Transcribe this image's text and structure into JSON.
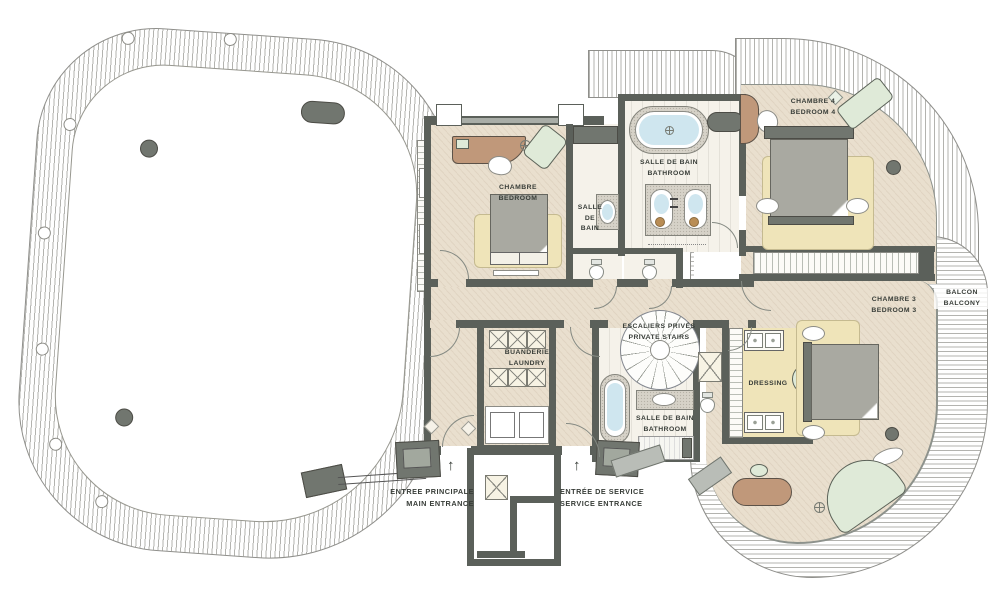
{
  "colors": {
    "wall": "#5b605a",
    "ink": "#383d38",
    "floor": "#e9dfce",
    "rug": "#efe4b9",
    "bath": "#f5f2ea",
    "stone": "#d6d2c8",
    "gray": "#a9a9a1",
    "graydark": "#71766f",
    "brown": "#c0987a",
    "green": "#dfead8",
    "water": "#cfe6ef",
    "hatch": "#b3b3af"
  },
  "labels": {
    "bedroom1_fr": "CHAMBRE",
    "bedroom1_en": "BEDROOM",
    "bath_small_1": "SALLE",
    "bath_small_2": "DE",
    "bath_small_3": "BAIN",
    "bath_top_fr": "SALLE DE BAIN",
    "bath_top_en": "BATHROOM",
    "bedroom4_fr": "CHAMBRE 4",
    "bedroom4_en": "BEDROOM 4",
    "bedroom3_fr": "CHAMBRE 3",
    "bedroom3_en": "BEDROOM 3",
    "balcony_fr": "BALCON",
    "balcony_en": "BALCONY",
    "stairs_fr": "ESCALIERS PRIVÉS",
    "stairs_en": "PRIVATE STAIRS",
    "laundry_fr": "BUANDERIE",
    "laundry_en": "LAUNDRY",
    "dressing": "DRESSING",
    "bath3_fr": "SALLE DE BAIN",
    "bath3_en": "BATHROOM",
    "entrance_main_fr": "ENTREE PRINCIPALE",
    "entrance_main_en": "MAIN ENTRANCE",
    "entrance_service_fr": "ENTRÉE DE SERVICE",
    "entrance_service_en": "SERVICE ENTRANCE",
    "arrow_up": "↑"
  }
}
